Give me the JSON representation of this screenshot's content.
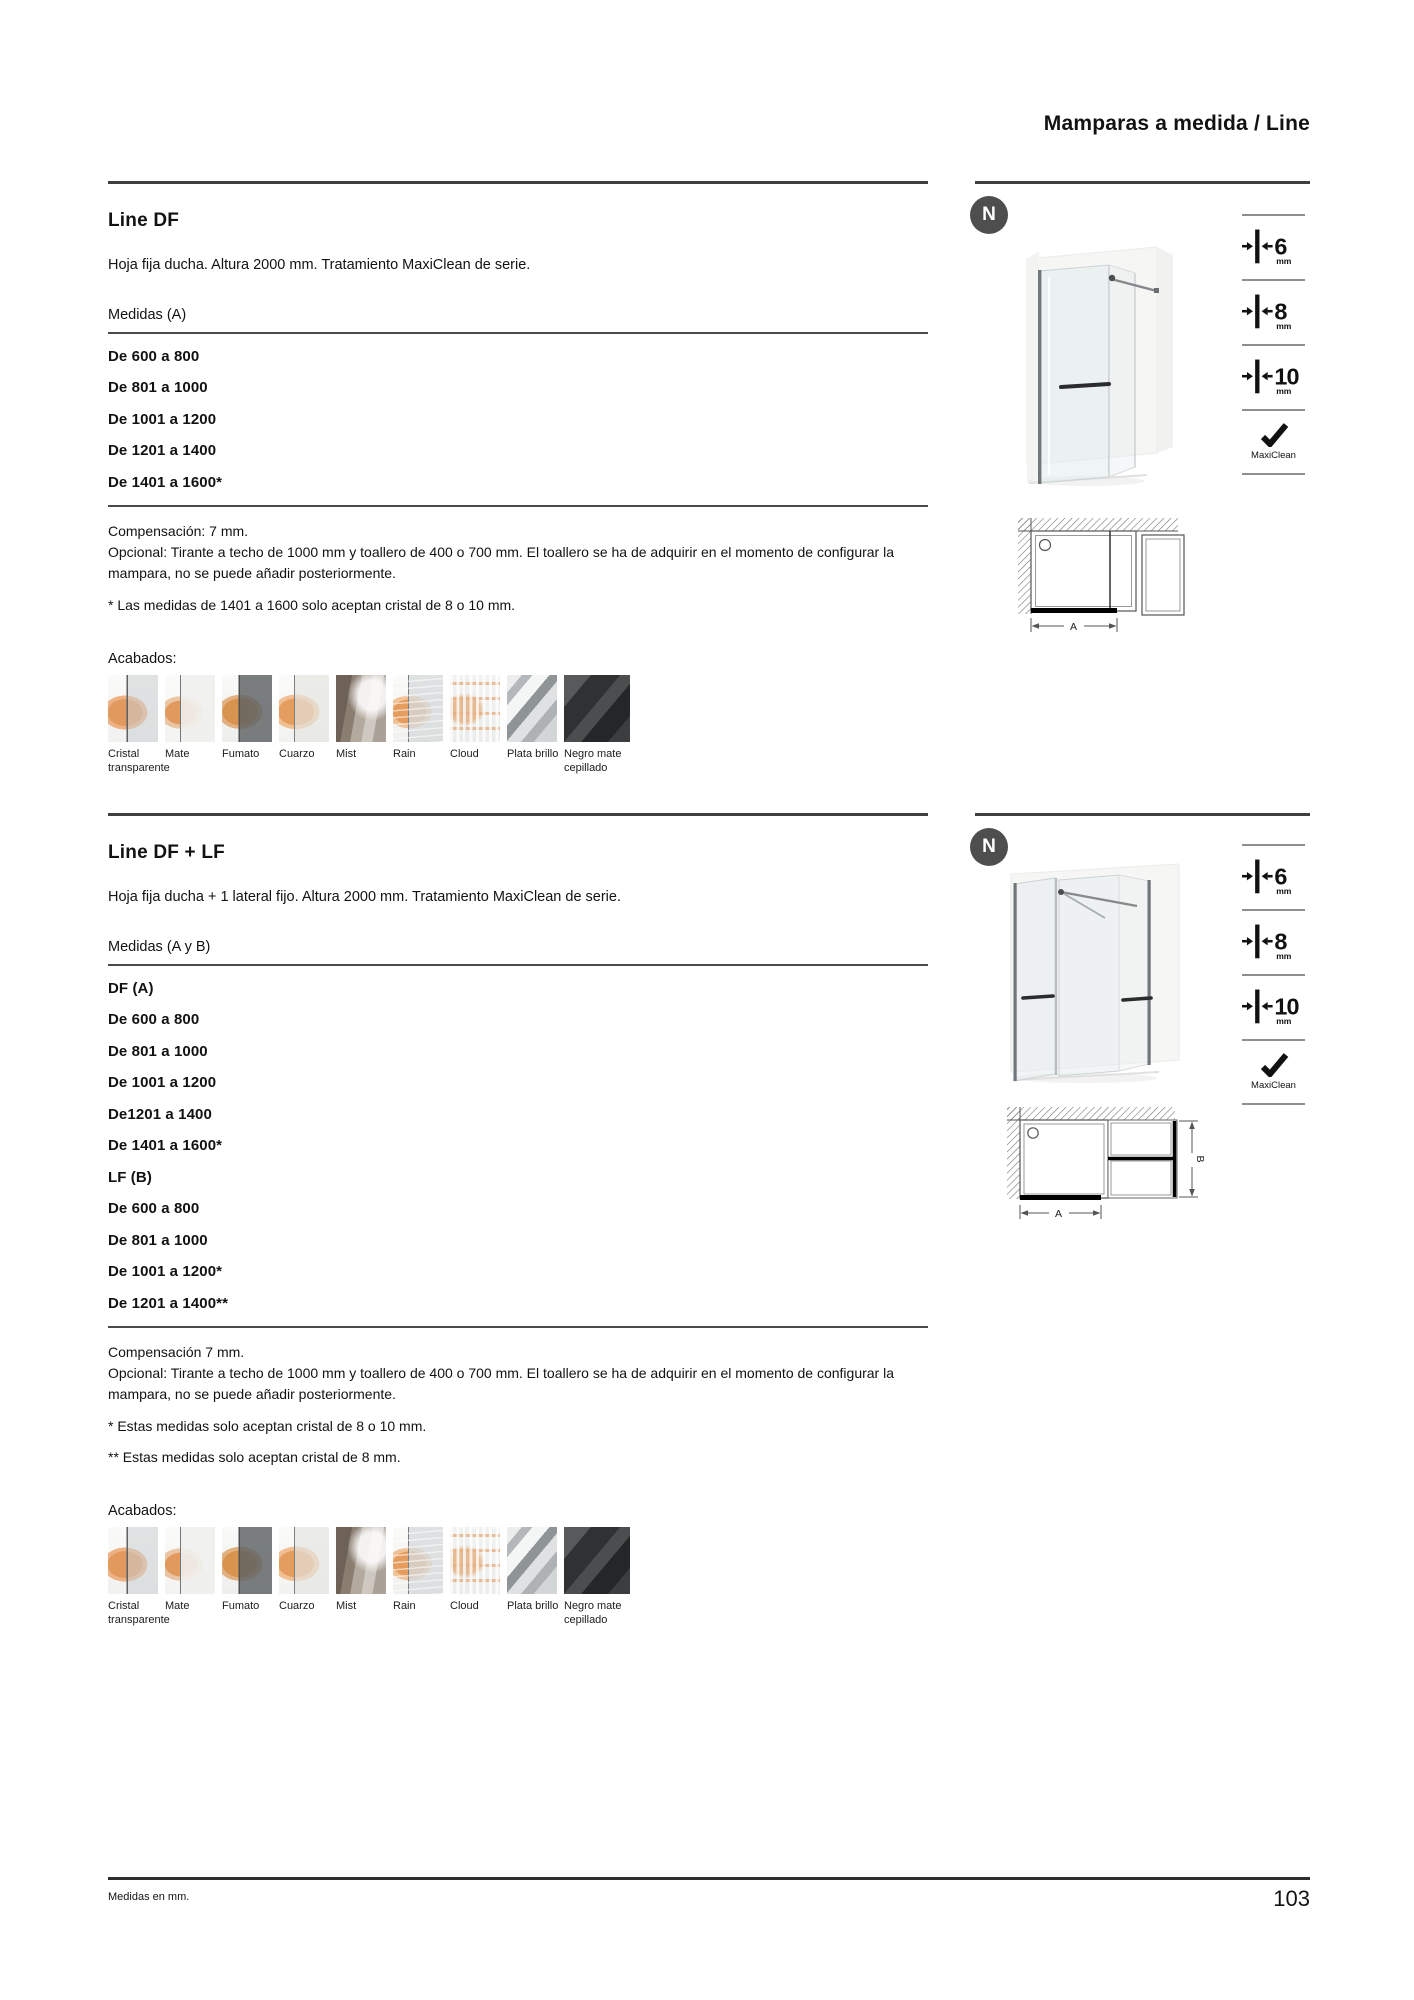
{
  "header": {
    "title": "Mamparas a medida / Line"
  },
  "badge": {
    "label": "N"
  },
  "legend": {
    "items": [
      {
        "num": "6",
        "unit": "mm"
      },
      {
        "num": "8",
        "unit": "mm"
      },
      {
        "num": "10",
        "unit": "mm"
      }
    ],
    "maxiclean": "MaxiClean"
  },
  "finishes": {
    "label": "Acabados:",
    "items": [
      {
        "name": "Cristal transparente",
        "type": "cristal"
      },
      {
        "name": "Mate",
        "type": "mate"
      },
      {
        "name": "Fumato",
        "type": "fumato"
      },
      {
        "name": "Cuarzo",
        "type": "cuarzo"
      },
      {
        "name": "Mist",
        "type": "mist"
      },
      {
        "name": "Rain",
        "type": "rain"
      },
      {
        "name": "Cloud",
        "type": "cloud"
      },
      {
        "name": "Plata brillo",
        "type": "plata"
      },
      {
        "name": "Negro mate cepillado",
        "type": "negro"
      }
    ]
  },
  "sections": [
    {
      "title": "Line DF",
      "description": "Hoja fija ducha. Altura 2000 mm. Tratamiento MaxiClean de serie.",
      "measures_label": "Medidas (A)",
      "measures": [
        "De 600 a 800",
        "De 801 a 1000",
        "De 1001 a 1200",
        "De 1201 a 1400",
        "De 1401 a 1600*"
      ],
      "notes": [
        "Compensación: 7 mm.",
        "Opcional: Tirante a techo de 1000 mm y toallero de 400 o 700 mm. El toallero se ha de adquirir en el momento de configurar la mampara, no se puede añadir posteriormente."
      ],
      "footnotes": [
        "* Las medidas de 1401 a 1600 solo aceptan cristal de 8 o 10 mm."
      ],
      "diagram": {
        "a": "A"
      }
    },
    {
      "title": "Line DF + LF",
      "description": "Hoja fija ducha + 1 lateral fijo. Altura 2000 mm. Tratamiento MaxiClean de serie.",
      "measures_label": "Medidas (A y B)",
      "measures": [
        "DF (A)",
        "De 600 a 800",
        "De 801 a 1000",
        "De 1001 a 1200",
        "De1201 a 1400",
        "De 1401 a 1600*",
        "LF (B)",
        "De 600 a 800",
        "De 801 a 1000",
        "De 1001 a 1200*",
        "De 1201 a 1400**"
      ],
      "notes": [
        "Compensación 7 mm.",
        "Opcional: Tirante a techo de 1000 mm y toallero de 400 o 700 mm. El toallero se ha de adquirir en el momento de configurar la mampara, no se puede añadir posteriormente."
      ],
      "footnotes": [
        "* Estas medidas solo aceptan cristal de 8 o 10 mm.",
        "** Estas medidas solo aceptan cristal de 8 mm."
      ],
      "diagram": {
        "a": "A",
        "b": "B"
      }
    }
  ],
  "footer": {
    "note": "Medidas en mm.",
    "page": "103"
  }
}
